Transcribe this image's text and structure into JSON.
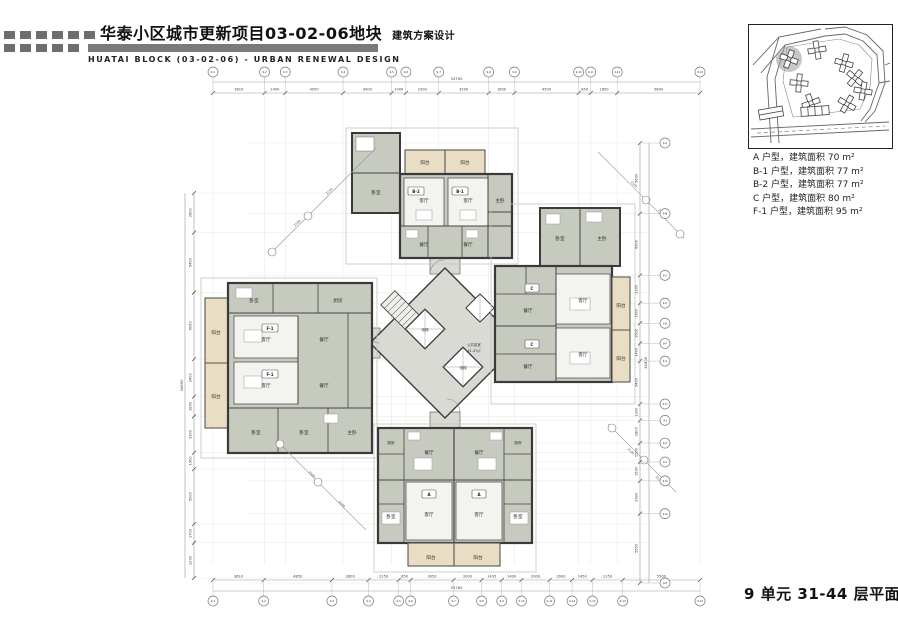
{
  "header": {
    "title_cn": "华泰小区城市更新项目03-02-06地块",
    "title_suffix": "建筑方案设计",
    "title_en": "HUATAI BLOCK (03-02-06) - URBAN RENEWAL DESIGN"
  },
  "legend": {
    "items": [
      "A  户型，建筑面积 70 m²",
      "B-1 户型，建筑面积 77 m²",
      "B-2 户型，建筑面积 77 m²",
      "C  户型，建筑面积 80 m²",
      "F-1 户型，建筑面积 95 m²"
    ]
  },
  "caption": "9 单元 31-44 层平面图",
  "rooms": {
    "living": "客厅",
    "dining": "餐厅",
    "bedroom": "卧室",
    "master": "主卧",
    "kitchen": "厨房",
    "balcony": "阳台",
    "elevator": "电梯",
    "lobby": "公共前室",
    "lobby_area": "41.47㎡"
  },
  "units": {
    "a": "A",
    "b1": "B-1",
    "b2": "B-2",
    "c": "C",
    "f1": "F-1"
  },
  "plan": {
    "total_top": "34700",
    "dims_top": [
      "3610",
      "1450",
      "4050",
      "3400",
      "1000",
      "2300",
      "3500",
      "1800",
      "4500",
      "850",
      "1850",
      "5800"
    ],
    "bubbles_top": [
      "9-1",
      "9-2",
      "9-3",
      "9-4",
      "9-5",
      "9-6",
      "9-7",
      "9-8",
      "9-9",
      "9-10",
      "9-11",
      "9-12",
      "9-13"
    ],
    "total_bottom": "34760",
    "dims_bottom": [
      "3610",
      "4850",
      "2600",
      "2150",
      "850",
      "3050",
      "2000",
      "1435",
      "1400",
      "2000",
      "1600",
      "1450",
      "2150",
      "5500"
    ],
    "bubbles_bottom": [
      "9-1",
      "9-2",
      "9-3",
      "9-4",
      "9-5",
      "9-6",
      "9-7",
      "9-8",
      "9-9",
      "9-10",
      "9-11",
      "9-12",
      "9-13",
      "9-14",
      "9-15"
    ],
    "total_left": "34950",
    "dims_left": [
      "3600",
      "5450",
      "6050",
      "3400",
      "1800",
      "3300",
      "1500",
      "5000",
      "1700",
      "3200"
    ],
    "total_right": "34900",
    "dims_right": [
      "5600",
      "4900",
      "2200",
      "1600",
      "1600",
      "1400",
      "3400",
      "1300",
      "1800",
      "1500",
      "1500",
      "2600",
      "5500"
    ],
    "bubbles_right": [
      "9-A",
      "9-B",
      "9-C",
      "9-D",
      "9-E",
      "9-F",
      "9-G",
      "9-H",
      "9-J",
      "9-K",
      "9-L",
      "9-M",
      "9-N",
      "9-P"
    ],
    "diag": [
      "2150",
      "2700",
      "1500",
      "2700",
      "1500",
      "3200",
      "2100",
      "3100"
    ]
  }
}
